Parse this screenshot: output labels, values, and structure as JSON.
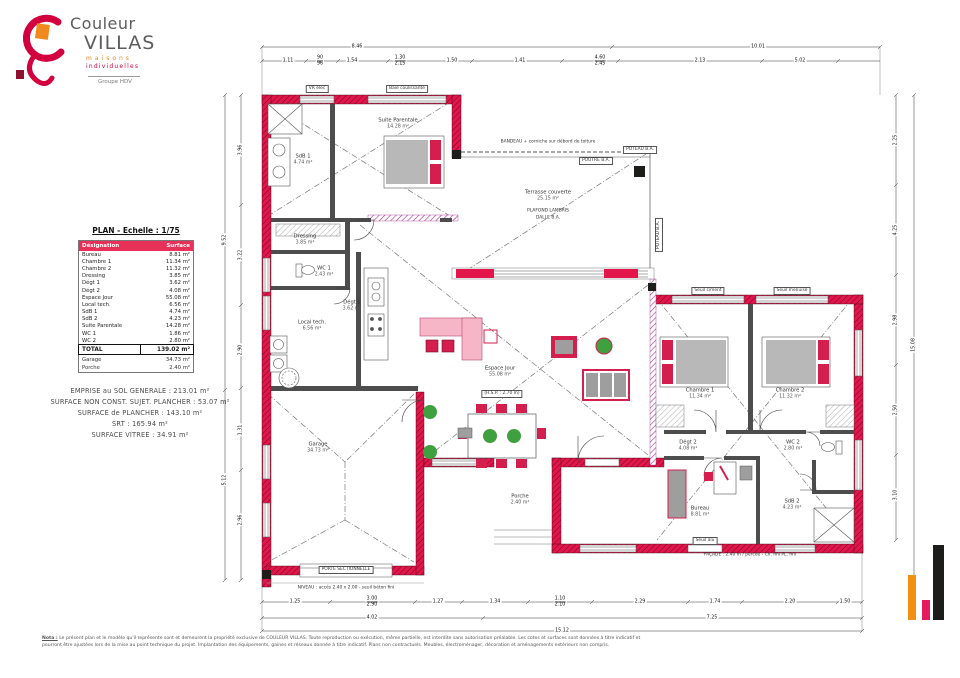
{
  "logo": {
    "brand_top": "Couleur",
    "brand_main": "VILLAS",
    "tagline_1": "maisons",
    "tagline_2": "individuelles",
    "group": "Groupe HDV"
  },
  "table": {
    "title": "PLAN - Echelle : 1/75",
    "headers": [
      "Désignation",
      "Surface"
    ],
    "rows": [
      [
        "Bureau",
        "8.81 m²"
      ],
      [
        "Chambre 1",
        "11.34 m²"
      ],
      [
        "Chambre 2",
        "11.32 m²"
      ],
      [
        "Dressing",
        "3.85 m²"
      ],
      [
        "Dégt 1",
        "3.62 m²"
      ],
      [
        "Dégt 2",
        "4.08 m²"
      ],
      [
        "Espace Jour",
        "55.08 m²"
      ],
      [
        "Local tech.",
        "6.56 m²"
      ],
      [
        "SdB 1",
        "4.74 m²"
      ],
      [
        "SdB 2",
        "4.23 m²"
      ],
      [
        "Suite Parentale",
        "14.28 m²"
      ],
      [
        "WC 1",
        "1.86 m²"
      ],
      [
        "WC 2",
        "2.80 m²"
      ]
    ],
    "total": [
      "TOTAL",
      "139.02 m²"
    ],
    "extra_rows": [
      [
        "Garage",
        "34.73 m²"
      ],
      [
        "Porche",
        "2.40 m²"
      ]
    ]
  },
  "surfaces": {
    "lines": [
      "EMPRISE au SOL GENERALE : 213.01 m²",
      "SURFACE NON CONST. SUJET. PLANCHER : 53.07 m²",
      "SURFACE de PLANCHER : 143.10 m²",
      "SRT : 165.94 m²",
      "SURFACE VITREE : 34.91 m²"
    ]
  },
  "plan": {
    "rooms": [
      {
        "name": "SdB 1",
        "area": "4.74 m²",
        "x": 303,
        "y": 160
      },
      {
        "name": "Suite Parentale",
        "area": "14.28 m²",
        "x": 398,
        "y": 124
      },
      {
        "name": "Dressing",
        "area": "3.85 m²",
        "x": 305,
        "y": 240
      },
      {
        "name": "WC 1",
        "area": "2.43 m²",
        "x": 324,
        "y": 272
      },
      {
        "name": "Dégt 1",
        "area": "3.62 m²",
        "x": 352,
        "y": 306
      },
      {
        "name": "Local tech.",
        "area": "6.56 m²",
        "x": 312,
        "y": 326
      },
      {
        "name": "Espace Jour",
        "area": "55.08 m²",
        "x": 500,
        "y": 372
      },
      {
        "name": "Terrasse couverte",
        "area": "25.15 m²",
        "x": 548,
        "y": 196
      },
      {
        "name": "Chambre 1",
        "area": "11.34 m²",
        "x": 700,
        "y": 394
      },
      {
        "name": "Chambre 2",
        "area": "11.32 m²",
        "x": 790,
        "y": 394
      },
      {
        "name": "Dégt 2",
        "area": "4.08 m²",
        "x": 688,
        "y": 446
      },
      {
        "name": "WC 2",
        "area": "2.80 m²",
        "x": 793,
        "y": 446
      },
      {
        "name": "Bureau",
        "area": "8.81 m²",
        "x": 700,
        "y": 512
      },
      {
        "name": "SdB 2",
        "area": "4.23 m²",
        "x": 792,
        "y": 505
      },
      {
        "name": "Garage",
        "area": "34.73 m²",
        "x": 318,
        "y": 448
      },
      {
        "name": "Porche",
        "area": "2.40 m²",
        "x": 520,
        "y": 500
      }
    ],
    "annotations": [
      {
        "text": "PLAFOND LAMBRIS",
        "x": 548,
        "y": 212
      },
      {
        "text": "DALLE B.A.",
        "x": 548,
        "y": 219
      },
      {
        "text": "(H.S.P. : 2.70 m)",
        "x": 502,
        "y": 394,
        "boxed": true
      },
      {
        "text": "POUTRE B.A.",
        "x": 596,
        "y": 161,
        "boxed": true
      },
      {
        "text": "POTEAU B.A.",
        "x": 640,
        "y": 150,
        "boxed": true
      },
      {
        "text": "POTEAU B.A.",
        "x": 659,
        "y": 235,
        "boxed": true,
        "rot": true
      },
      {
        "text": "BANDEAU + corniche sur débord de toiture",
        "x": 548,
        "y": 143
      },
      {
        "text": "VR élec",
        "x": 317,
        "y": 89,
        "boxed": true
      },
      {
        "text": "Baie coulissante",
        "x": 407,
        "y": 89,
        "boxed": true
      },
      {
        "text": "Seuil ciment",
        "x": 708,
        "y": 291,
        "boxed": true
      },
      {
        "text": "Seuil menuisé",
        "x": 792,
        "y": 291,
        "boxed": true
      },
      {
        "text": "Seuil alu",
        "x": 705,
        "y": 541,
        "boxed": true
      },
      {
        "text": "PORTE SECTIONNELLE",
        "x": 346,
        "y": 570,
        "boxed": true
      },
      {
        "text": "NIVEAU : accès 2.40 x 2.00 - seuil béton fini",
        "x": 346,
        "y": 589
      },
      {
        "text": "FAÇADE : 2.40 m / percée - Ch. fini PL. fini",
        "x": 750,
        "y": 556
      }
    ],
    "dimensions": [
      {
        "x": 357,
        "y": 47,
        "v": "8.46"
      },
      {
        "x": 758,
        "y": 47,
        "v": "10.01"
      },
      {
        "x": 288,
        "y": 61,
        "v": "1.11"
      },
      {
        "x": 320,
        "y": 61,
        "v": "90",
        "v2": "96"
      },
      {
        "x": 352,
        "y": 61,
        "v": "1.54"
      },
      {
        "x": 400,
        "y": 61,
        "v": "1.30",
        "v2": "2.15"
      },
      {
        "x": 452,
        "y": 61,
        "v": "1.50"
      },
      {
        "x": 520,
        "y": 61,
        "v": "1.41"
      },
      {
        "x": 600,
        "y": 61,
        "v": "4.60",
        "v2": "2.45"
      },
      {
        "x": 700,
        "y": 61,
        "v": "2.13"
      },
      {
        "x": 800,
        "y": 61,
        "v": "5.02"
      },
      {
        "x": 225,
        "y": 240,
        "v": "9.52",
        "vert": true
      },
      {
        "x": 225,
        "y": 480,
        "v": "5.12",
        "vert": true
      },
      {
        "x": 241,
        "y": 150,
        "v": "3.96",
        "vert": true
      },
      {
        "x": 241,
        "y": 255,
        "v": "3.22",
        "vert": true
      },
      {
        "x": 241,
        "y": 350,
        "v": "2.90",
        "vert": true
      },
      {
        "x": 241,
        "y": 430,
        "v": "1.31",
        "vert": true
      },
      {
        "x": 241,
        "y": 520,
        "v": "2.96",
        "vert": true
      },
      {
        "x": 896,
        "y": 140,
        "v": "2.25",
        "vert": true
      },
      {
        "x": 896,
        "y": 230,
        "v": "4.25",
        "vert": true
      },
      {
        "x": 896,
        "y": 320,
        "v": "2.98",
        "vert": true
      },
      {
        "x": 896,
        "y": 410,
        "v": "2.50",
        "vert": true
      },
      {
        "x": 896,
        "y": 495,
        "v": "3.10",
        "vert": true
      },
      {
        "x": 914,
        "y": 345,
        "v": "15.08",
        "vert": true
      },
      {
        "x": 295,
        "y": 602,
        "v": "1.25"
      },
      {
        "x": 372,
        "y": 602,
        "v": "3.00",
        "v2": "2.90"
      },
      {
        "x": 438,
        "y": 602,
        "v": "1.27"
      },
      {
        "x": 495,
        "y": 602,
        "v": "1.34"
      },
      {
        "x": 560,
        "y": 602,
        "v": "1.10",
        "v2": "2.10"
      },
      {
        "x": 640,
        "y": 602,
        "v": "2.29"
      },
      {
        "x": 715,
        "y": 602,
        "v": "1.74"
      },
      {
        "x": 790,
        "y": 602,
        "v": "2.20"
      },
      {
        "x": 845,
        "y": 602,
        "v": "1.50"
      },
      {
        "x": 372,
        "y": 618,
        "v": "4.02"
      },
      {
        "x": 712,
        "y": 618,
        "v": "7.25"
      },
      {
        "x": 562,
        "y": 631,
        "v": "15.12"
      }
    ]
  },
  "note": {
    "prefix": "Nota :",
    "line1": "Le présent plan et le modèle qu'il représente sont et demeurent la propriété exclusive de COULEUR VILLAS. Toute reproduction ou exécution, même partielle, est interdite sans autorisation préalable. Les cotes et surfaces sont données à titre indicatif et",
    "line2": "pourront être ajustées lors de la mise au point technique du projet. Implantation des équipements, gaines et réseaux donnée à titre indicatif. Plans non contractuels. Meubles, électroménager, décoration et aménagements extérieurs non compris."
  },
  "brand_bars": [
    {
      "name": "bar-orange",
      "color": "#f29111",
      "x": 908,
      "y": 575,
      "w": 8,
      "h": 45
    },
    {
      "name": "bar-pink",
      "color": "#e51a5f",
      "x": 922,
      "y": 600,
      "w": 8,
      "h": 20
    },
    {
      "name": "bar-black",
      "color": "#1d1d1b",
      "x": 933,
      "y": 545,
      "w": 11,
      "h": 75
    }
  ],
  "colors": {
    "wall_red": "#e2164a",
    "wall_magenta": "#a0338f",
    "table_header": "#e73158",
    "logo_red": "#d3003f",
    "logo_orange": "#f08a1d"
  }
}
